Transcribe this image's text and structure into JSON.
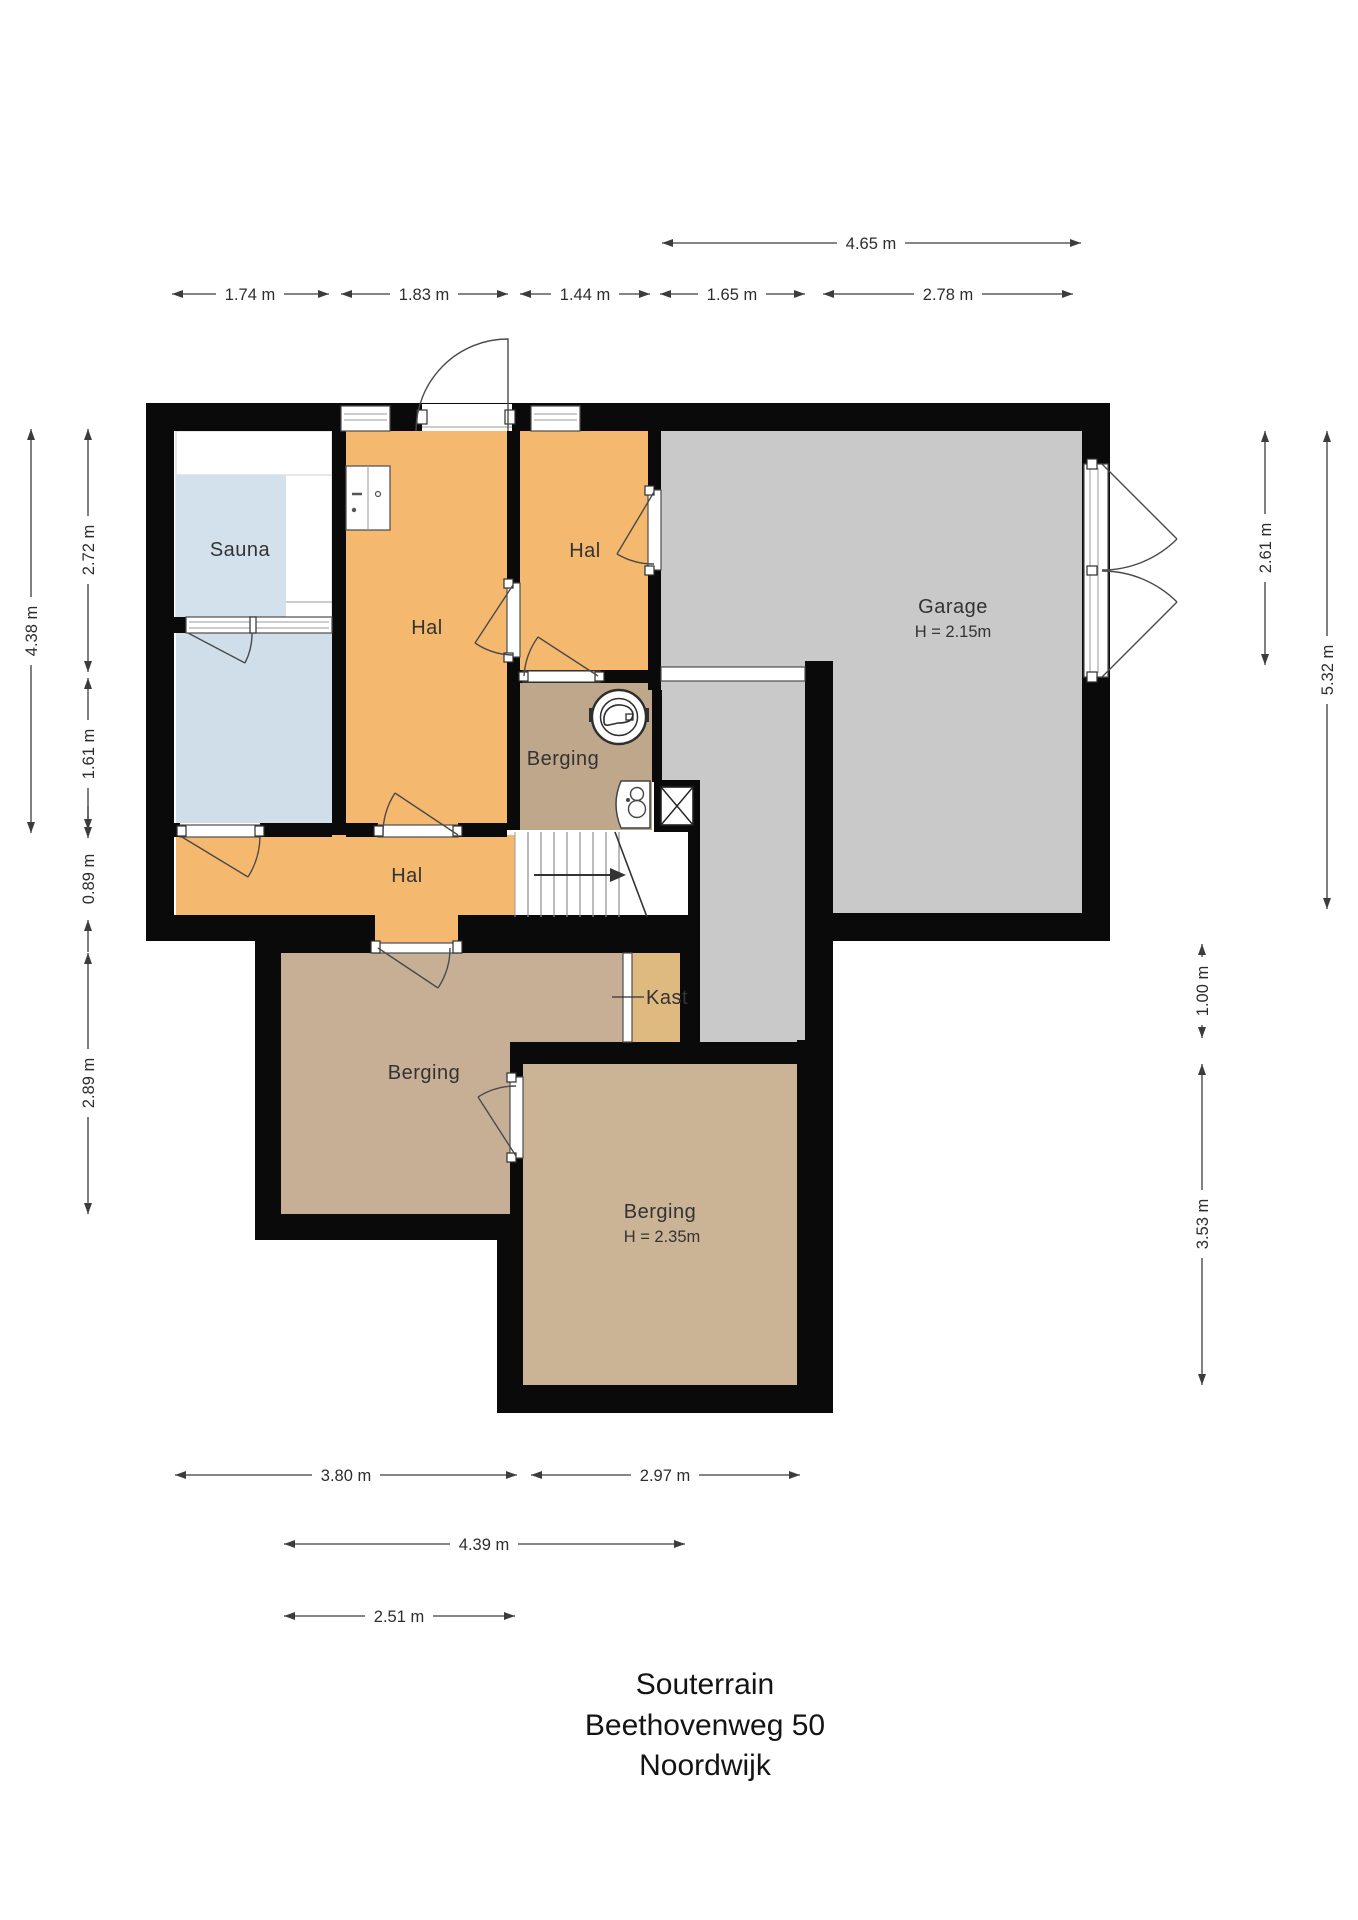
{
  "title": {
    "line1": "Souterrain",
    "line2": "Beethovenweg 50",
    "line3": "Noordwijk"
  },
  "rooms": {
    "sauna": "Sauna",
    "hal_main": "Hal",
    "hal_top": "Hal",
    "hal_lower": "Hal",
    "garage": "Garage",
    "garage_height": "H = 2.15m",
    "berging_washer": "Berging",
    "berging_left": "Berging",
    "berging_big": "Berging",
    "berging_big_height": "H = 2.35m",
    "kast": "Kast"
  },
  "dimensions": {
    "top_total": "4.65 m",
    "top_1": "1.74 m",
    "top_2": "1.83 m",
    "top_3": "1.44 m",
    "top_4": "1.65 m",
    "top_5": "2.78 m",
    "left_total": "4.38 m",
    "left_1": "2.72 m",
    "left_2": "1.61 m",
    "left_3": "0.89 m",
    "left_4": "2.89 m",
    "right_1": "2.61 m",
    "right_2": "5.32 m",
    "right_3": "1.00 m",
    "right_4": "3.53 m",
    "bottom_1": "3.80 m",
    "bottom_2": "2.97 m",
    "bottom_3": "4.39 m",
    "bottom_4": "2.51 m"
  },
  "colors": {
    "wall": "#0a0a0a",
    "hal": "#F4B96E",
    "sauna": "#D3E1EC",
    "bathroom": "#CFDEE9",
    "garage": "#C9C9C9",
    "berging_washer": "#BFA78C",
    "berging_left": "#C6AF94",
    "berging_big": "#CBB496",
    "kast": "#DFBA80",
    "dimension": "#3C3C3C"
  }
}
